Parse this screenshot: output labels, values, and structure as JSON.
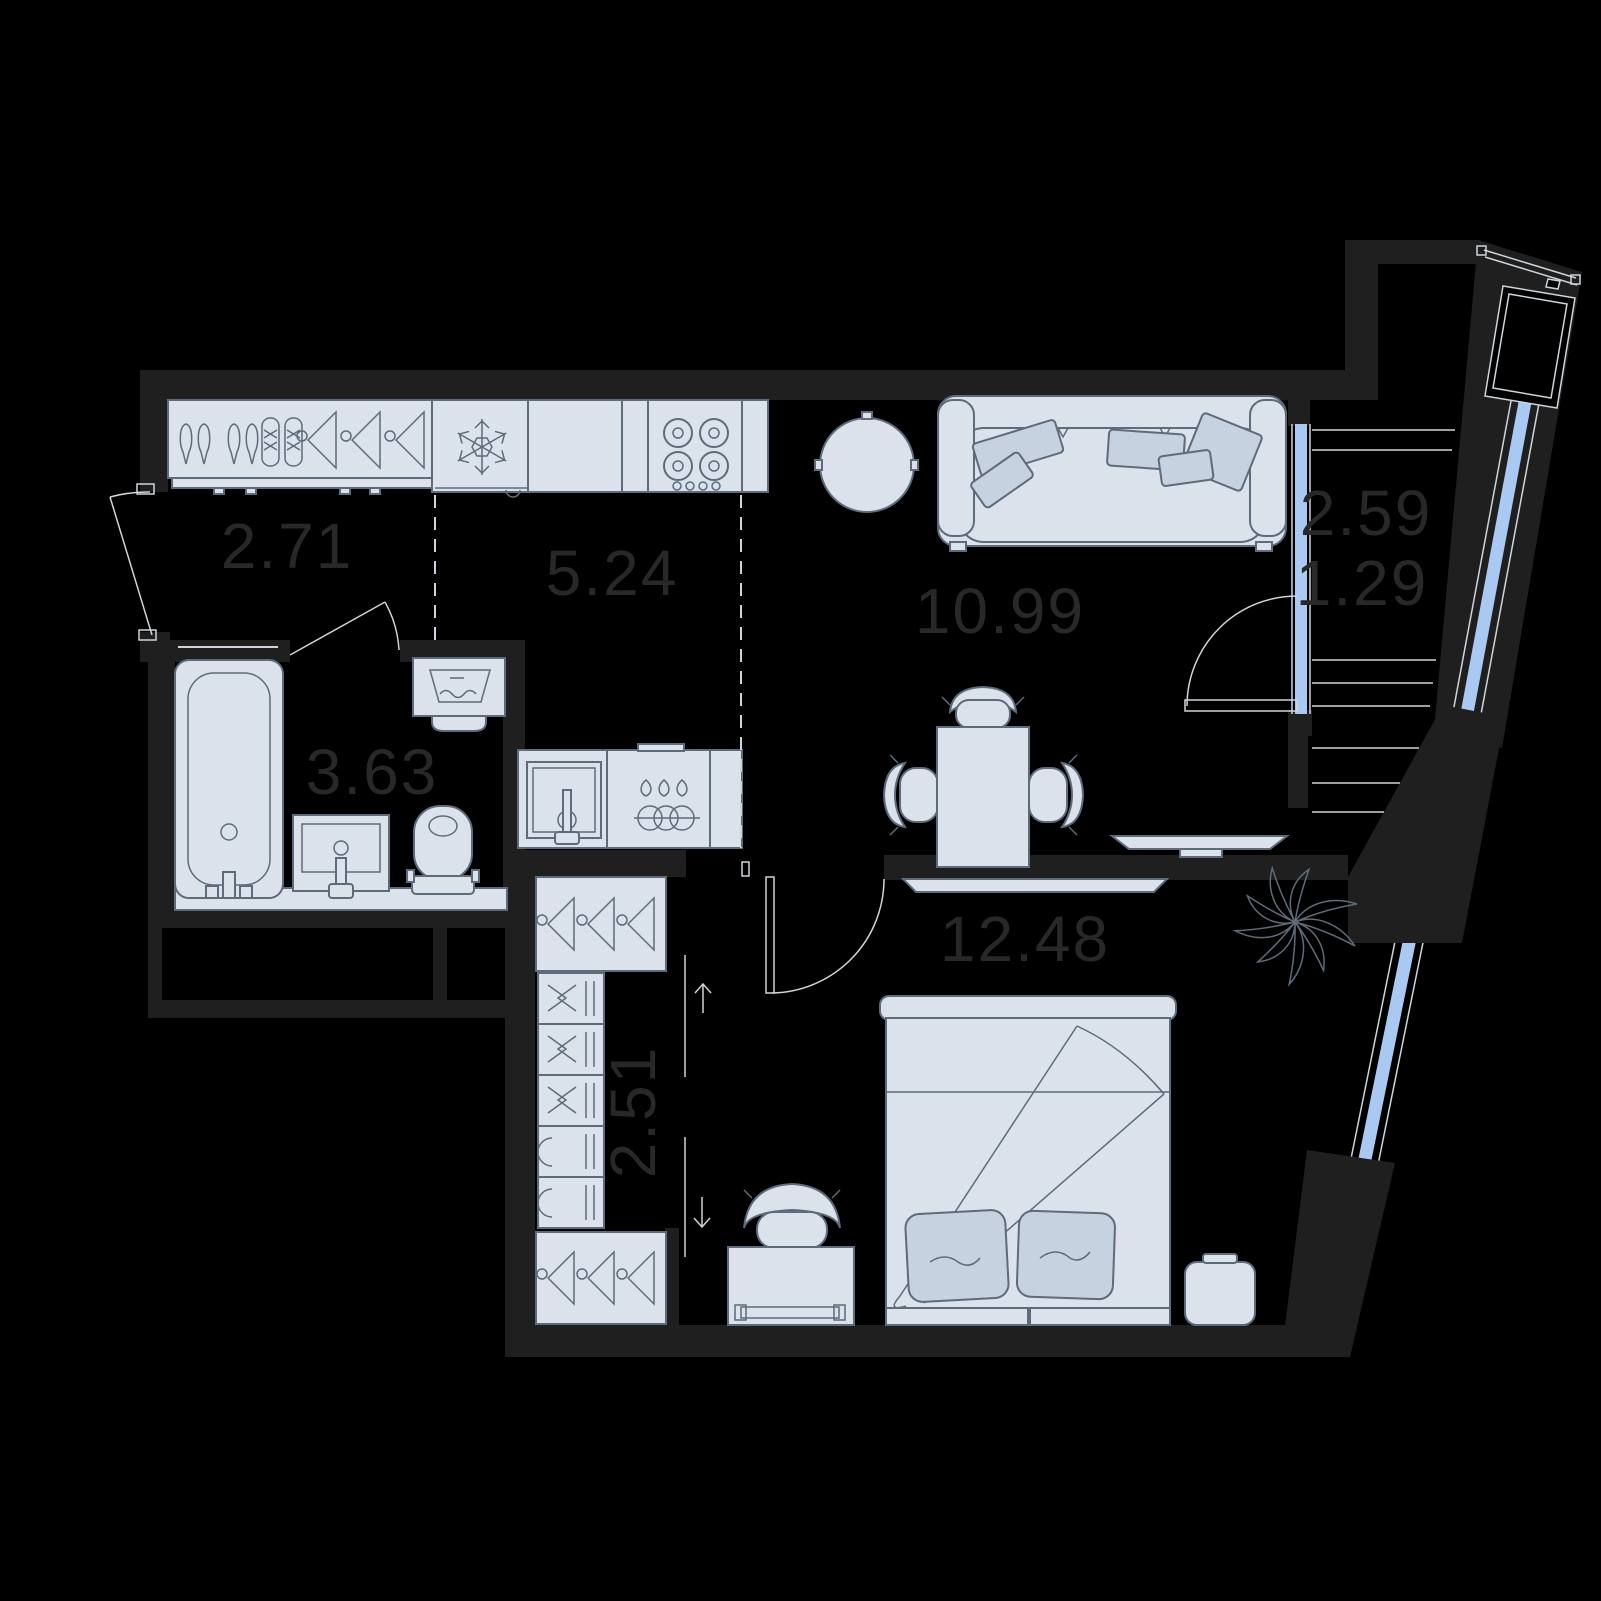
{
  "plan": {
    "type": "apartment-floor-plan",
    "rooms": [
      {
        "name": "hallway",
        "area": "2.71"
      },
      {
        "name": "kitchen",
        "area": "5.24"
      },
      {
        "name": "living-room",
        "area": "10.99"
      },
      {
        "name": "balcony",
        "area": "2.59"
      },
      {
        "name": "balcony-reduced",
        "area": "1.29"
      },
      {
        "name": "bathroom",
        "area": "3.63"
      },
      {
        "name": "bedroom",
        "area": "12.48"
      },
      {
        "name": "wardrobe",
        "area": "2.51"
      }
    ],
    "colors": {
      "background": "#000000",
      "wall": "#1f1f1f",
      "furniture_fill": "#dce2ec",
      "furniture_accent": "#c6d2e0",
      "furniture_stroke": "#5d6b7a",
      "glazing": "#aac9f2",
      "thin_line": "#cfd5dc",
      "label_text": "#282828"
    },
    "icons": [
      "shoe-rack",
      "coat-hanger",
      "fridge-snowflake",
      "hob-burners",
      "kitchen-sink",
      "dishwasher",
      "round-table",
      "sofa",
      "pillow",
      "dining-table",
      "chair",
      "tv",
      "bathtub",
      "washing-machine",
      "washbasin",
      "toilet",
      "wardrobe-shelf",
      "bed",
      "desk",
      "desk-chair",
      "nightstand",
      "plant",
      "air-conditioner",
      "stairs",
      "window",
      "door-swing",
      "direction-arrow"
    ]
  }
}
